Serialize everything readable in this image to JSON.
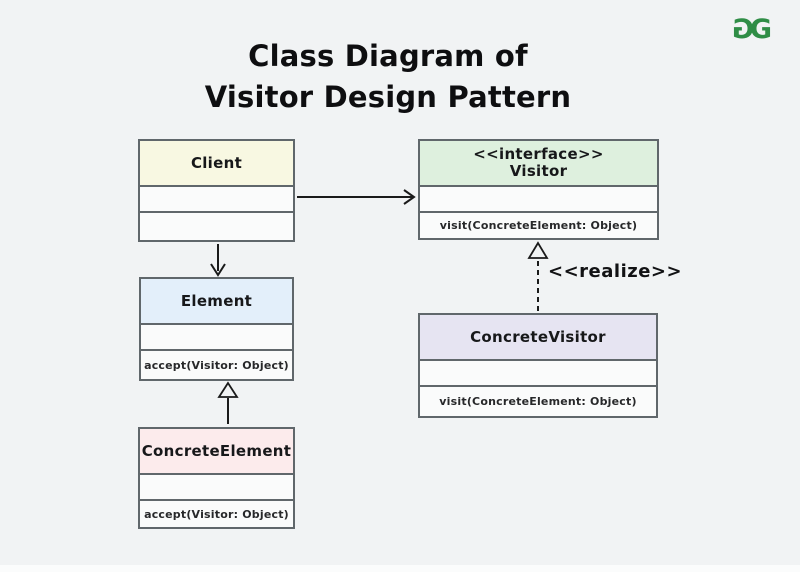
{
  "header": {
    "title_line1": "Class Diagram of",
    "title_line2": "Visitor Design Pattern"
  },
  "logo": {
    "brand": "GeeksforGeeks",
    "letter": "G",
    "color": "#2f8d46"
  },
  "classes": [
    {
      "name": "Client",
      "stereotype": "",
      "header_color": "#f8f8e2",
      "attributes": "",
      "method": ""
    },
    {
      "name": "Visitor",
      "stereotype": "<<interface>>",
      "header_color": "#def0de",
      "attributes": "",
      "method": "visit(ConcreteElement: Object)"
    },
    {
      "name": "Element",
      "stereotype": "",
      "header_color": "#e3effa",
      "attributes": "",
      "method": "accept(Visitor: Object)"
    },
    {
      "name": "ConcreteVisitor",
      "stereotype": "",
      "header_color": "#e6e4f2",
      "attributes": "",
      "method": "visit(ConcreteElement: Object)"
    },
    {
      "name": "ConcreteElement",
      "stereotype": "",
      "header_color": "#fcebec",
      "attributes": "",
      "method": "accept(Visitor: Object)"
    }
  ],
  "relations": {
    "client_visitor": {
      "type": "association-arrow",
      "from": "Client",
      "to": "Visitor"
    },
    "client_element": {
      "type": "association-arrow",
      "from": "Client",
      "to": "Element"
    },
    "concreteelement_element": {
      "type": "generalization-arrow",
      "from": "ConcreteElement",
      "to": "Element"
    },
    "concretevisitor_visitor": {
      "type": "realization-arrow",
      "from": "ConcreteVisitor",
      "to": "Visitor",
      "label": "<<realize>>"
    }
  },
  "colors": {
    "page_background": "#f1f3f4",
    "box_border": "#60676b",
    "compartment_fill": "#fafbfb",
    "connector": "#1a1a1a",
    "title_text": "#0e0e10"
  }
}
